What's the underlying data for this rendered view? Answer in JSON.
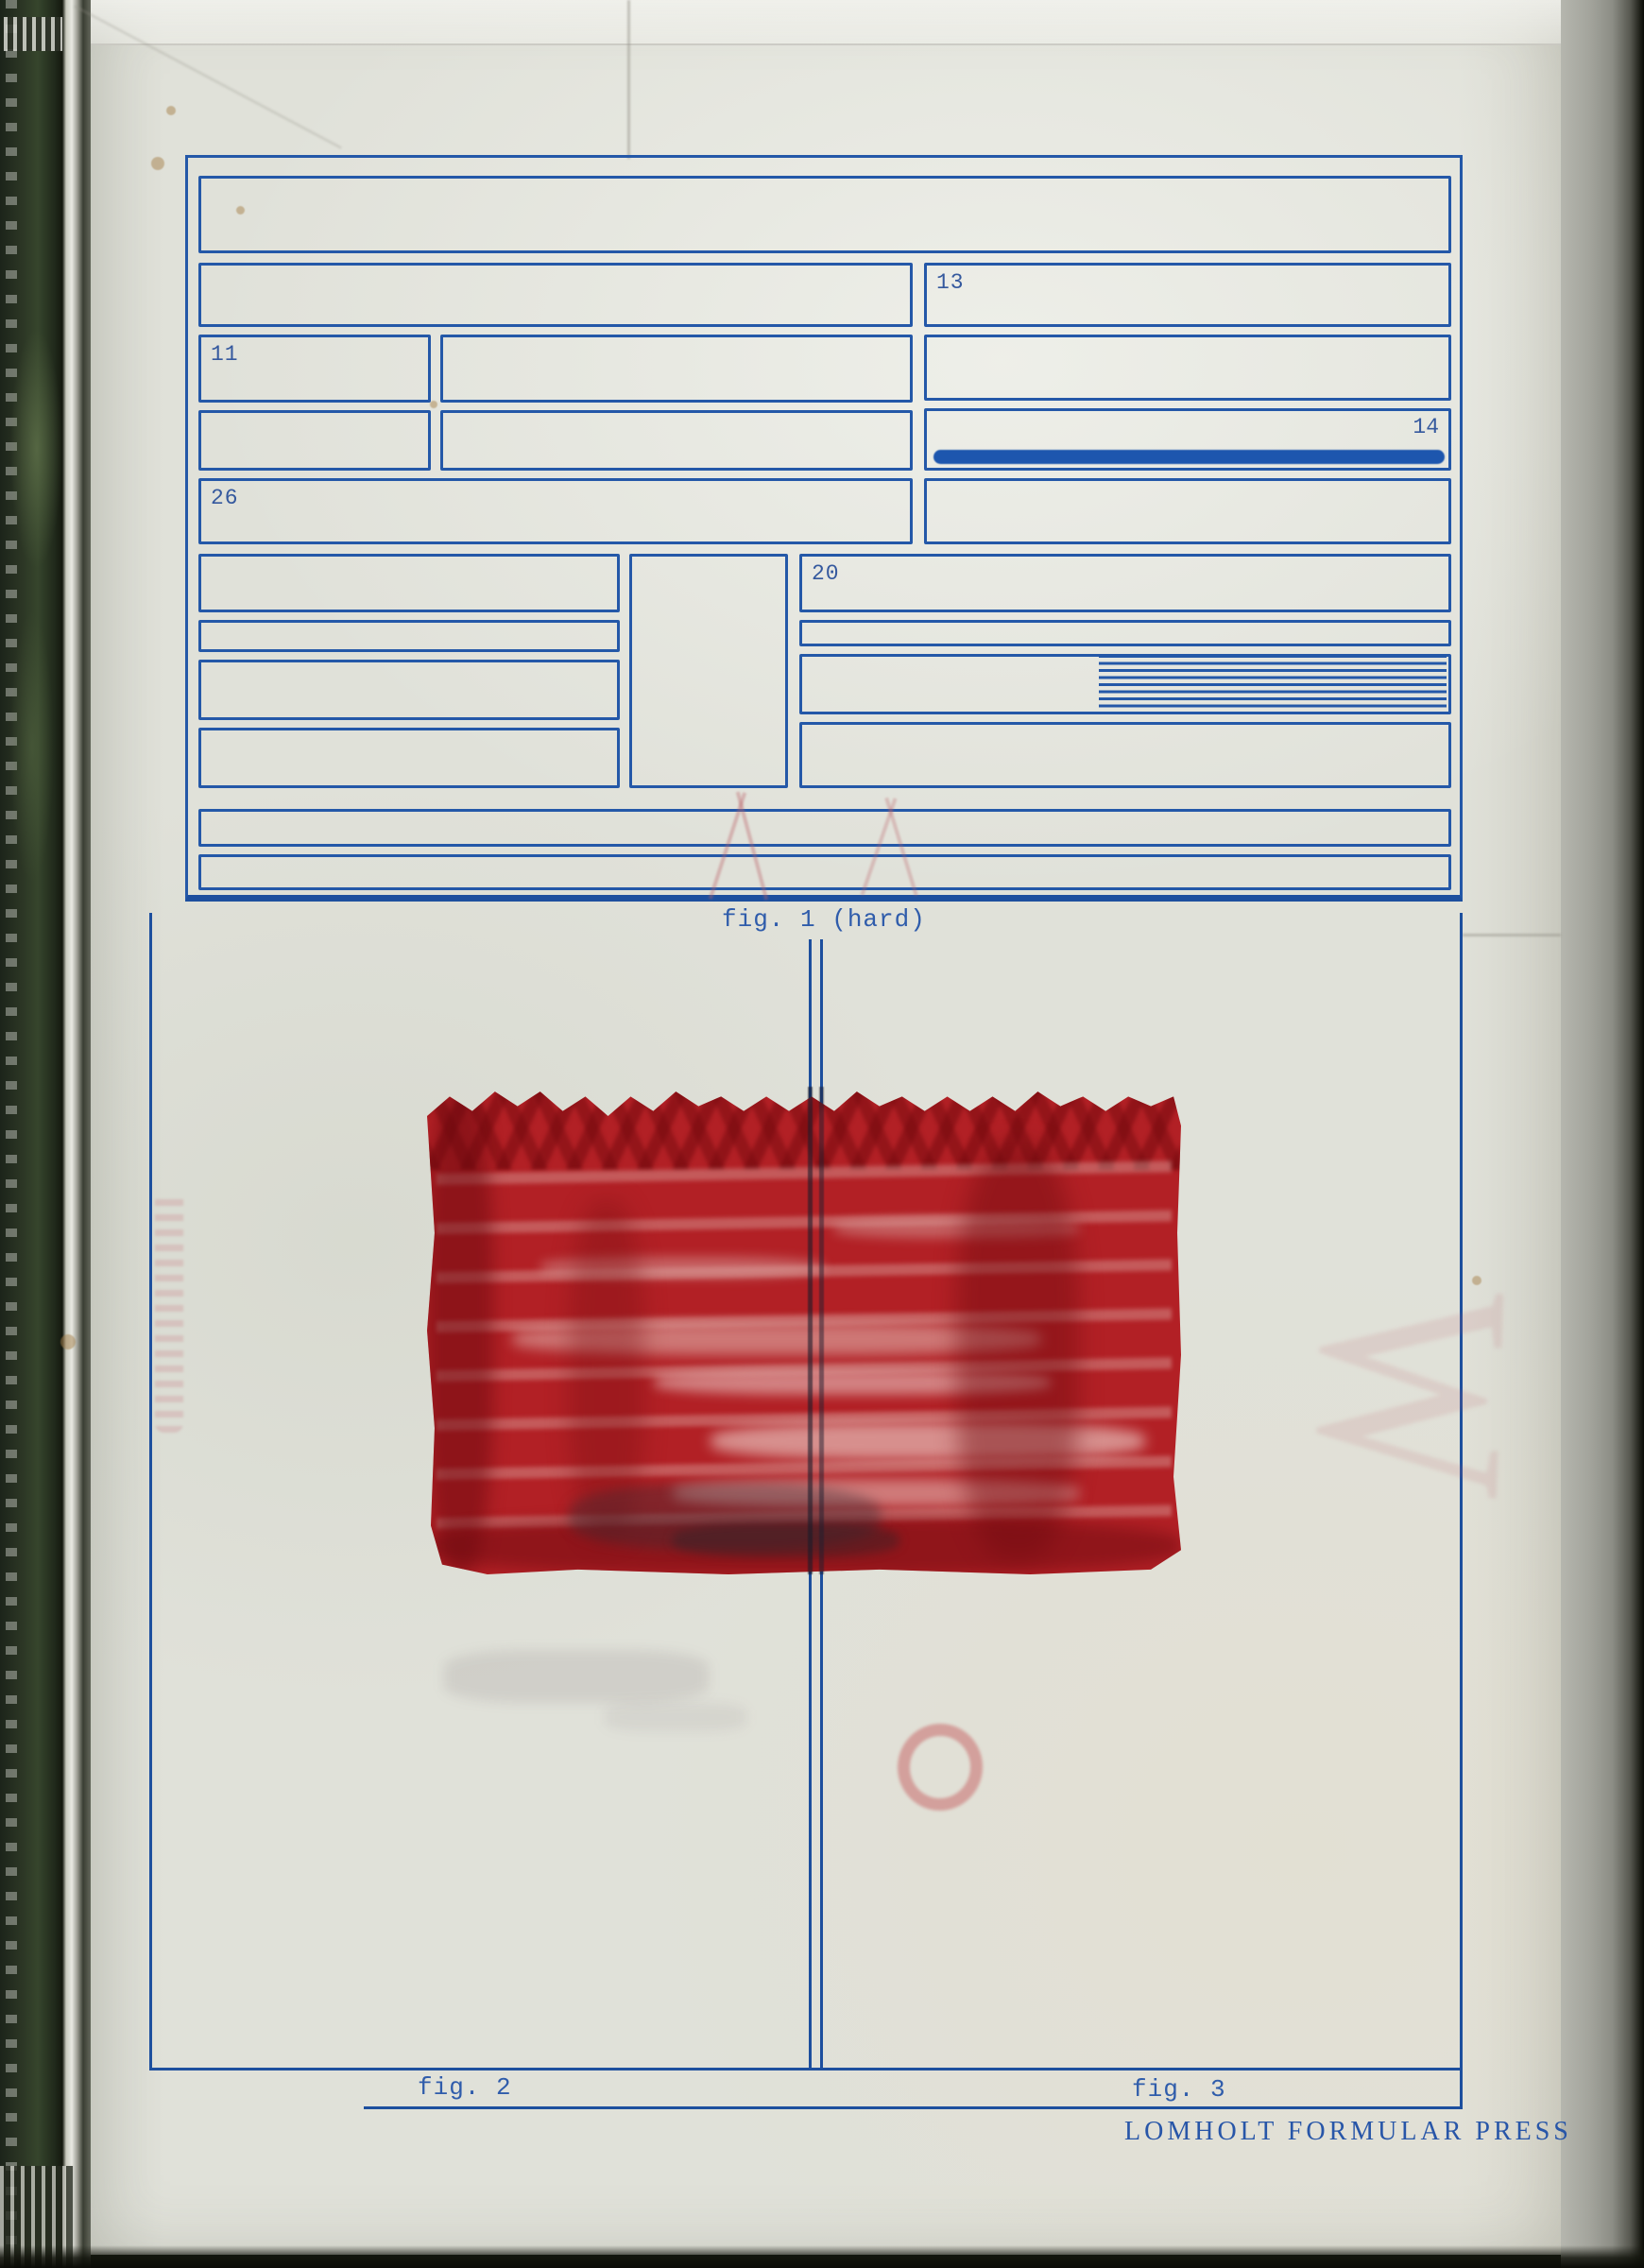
{
  "artwork": {
    "fig1_label": "fig. 1 (hard)",
    "fig2_label": "fig. 2",
    "fig3_label": "fig. 3",
    "imprint": "LOMHOLT FORMULAR PRESS"
  },
  "form": {
    "cell_numbers": {
      "c11": "11",
      "c13": "13",
      "c14": "14",
      "c20": "20",
      "c26": "26"
    }
  },
  "artifacts": {
    "ghost_glyph": "W"
  },
  "colors": {
    "ink_blue": "#2458a8",
    "paint_red": "#b22025",
    "paper": "#e0e1d9",
    "stamp_pink": "#c66062"
  }
}
